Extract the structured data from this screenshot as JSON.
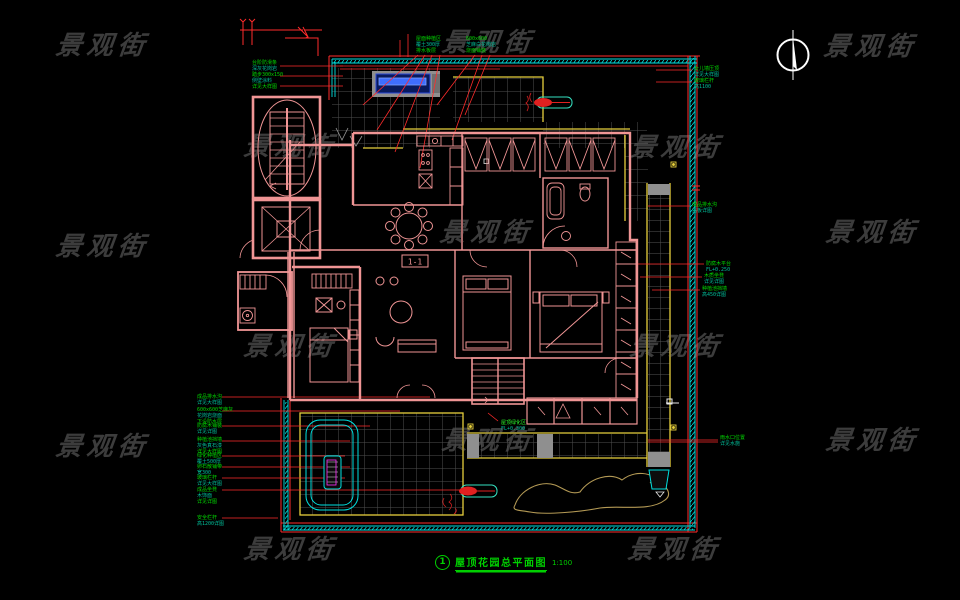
{
  "page": {
    "background": "#000000"
  },
  "watermark": {
    "text": "景观街",
    "color": "#3c3c3c",
    "positions": [
      {
        "x": 56,
        "y": 33
      },
      {
        "x": 442,
        "y": 30
      },
      {
        "x": 824,
        "y": 34
      },
      {
        "x": 244,
        "y": 134
      },
      {
        "x": 630,
        "y": 135
      },
      {
        "x": 56,
        "y": 234
      },
      {
        "x": 440,
        "y": 220
      },
      {
        "x": 826,
        "y": 220
      },
      {
        "x": 244,
        "y": 334
      },
      {
        "x": 630,
        "y": 334
      },
      {
        "x": 56,
        "y": 434
      },
      {
        "x": 442,
        "y": 428
      },
      {
        "x": 826,
        "y": 428
      },
      {
        "x": 244,
        "y": 537
      },
      {
        "x": 628,
        "y": 537
      }
    ]
  },
  "colors": {
    "wall_pink": "#f09595",
    "leader_red": "#ff2b2b",
    "cad_yellow": "#e6cf3c",
    "cyan": "#00e0e0",
    "annotation_green": "#00d800",
    "grid_grey": "#4f4f4f",
    "pool_blue": "#3f6eff",
    "magenta": "#ff30ff",
    "contour_tan": "#b49a55"
  },
  "section_tag": "1-1",
  "title_block": {
    "index": "1",
    "title": "屋顶花园总平面图",
    "scale": "1:100"
  },
  "labels": [
    {
      "id": "note-top-1",
      "x": 416,
      "y": 36,
      "lines": [
        "屋面种植区",
        "覆土300厚",
        "排水板层"
      ]
    },
    {
      "id": "note-top-2",
      "x": 466,
      "y": 36,
      "lines": [
        "600x600",
        "芝麻白花岗岩",
        "烧面铺装"
      ]
    },
    {
      "id": "note-stair",
      "x": 252,
      "y": 60,
      "lines": [
        "台阶防滑条",
        "深灰花岗岩",
        "踏步300x150",
        "侧壁涂料",
        "详见大样图"
      ]
    },
    {
      "id": "note-right-1",
      "x": 694,
      "y": 66,
      "lines": [
        "女儿墙压顶",
        "详见大样图"
      ]
    },
    {
      "id": "note-right-2",
      "x": 694,
      "y": 78,
      "lines": [
        "玻璃栏杆",
        "高1100"
      ]
    },
    {
      "id": "note-right-3",
      "x": 692,
      "y": 202,
      "lines": [
        "成品排水沟",
        "盖板详图"
      ]
    },
    {
      "id": "note-right-4",
      "x": 706,
      "y": 261,
      "lines": [
        "防腐木平台",
        "FL+0.250"
      ]
    },
    {
      "id": "note-right-5",
      "x": 704,
      "y": 273,
      "lines": [
        "木质坐凳",
        "详见详图"
      ]
    },
    {
      "id": "note-right-6",
      "x": 702,
      "y": 286,
      "lines": [
        "种植池挡墙",
        "高450详图"
      ]
    },
    {
      "id": "note-right-7",
      "x": 720,
      "y": 435,
      "lines": [
        "雨水口位置",
        "详见水施"
      ]
    },
    {
      "id": "note-left-1",
      "x": 197,
      "y": 394,
      "lines": [
        "成品排水沟",
        "详见大样图"
      ]
    },
    {
      "id": "note-left-2",
      "x": 197,
      "y": 407,
      "lines": [
        "600x600芝麻灰",
        "花岗岩烧面",
        "下设防水层"
      ]
    },
    {
      "id": "note-left-3",
      "x": 197,
      "y": 423,
      "lines": [
        "防腐木铺装",
        "详见详图"
      ]
    },
    {
      "id": "note-left-4",
      "x": 197,
      "y": 437,
      "lines": [
        "种植池挡墙",
        "灰色真石漆",
        "详见大样图"
      ]
    },
    {
      "id": "note-left-5",
      "x": 197,
      "y": 453,
      "lines": [
        "绿化种植区",
        "覆土500厚"
      ]
    },
    {
      "id": "note-left-6",
      "x": 197,
      "y": 464,
      "lines": [
        "卵石散铺带",
        "宽300"
      ]
    },
    {
      "id": "note-left-7",
      "x": 197,
      "y": 475,
      "lines": [
        "玻璃栏杆",
        "详见大样图"
      ]
    },
    {
      "id": "note-left-8",
      "x": 197,
      "y": 487,
      "lines": [
        "成品坐凳",
        "木饰面",
        "详见详图"
      ]
    },
    {
      "id": "note-left-9",
      "x": 197,
      "y": 515,
      "lines": [
        "安全栏杆",
        "高1200详图"
      ]
    },
    {
      "id": "note-terrace",
      "x": 501,
      "y": 420,
      "lines": [
        "屋顶绿化区",
        "FL+0.300"
      ],
      "bright": true
    }
  ]
}
